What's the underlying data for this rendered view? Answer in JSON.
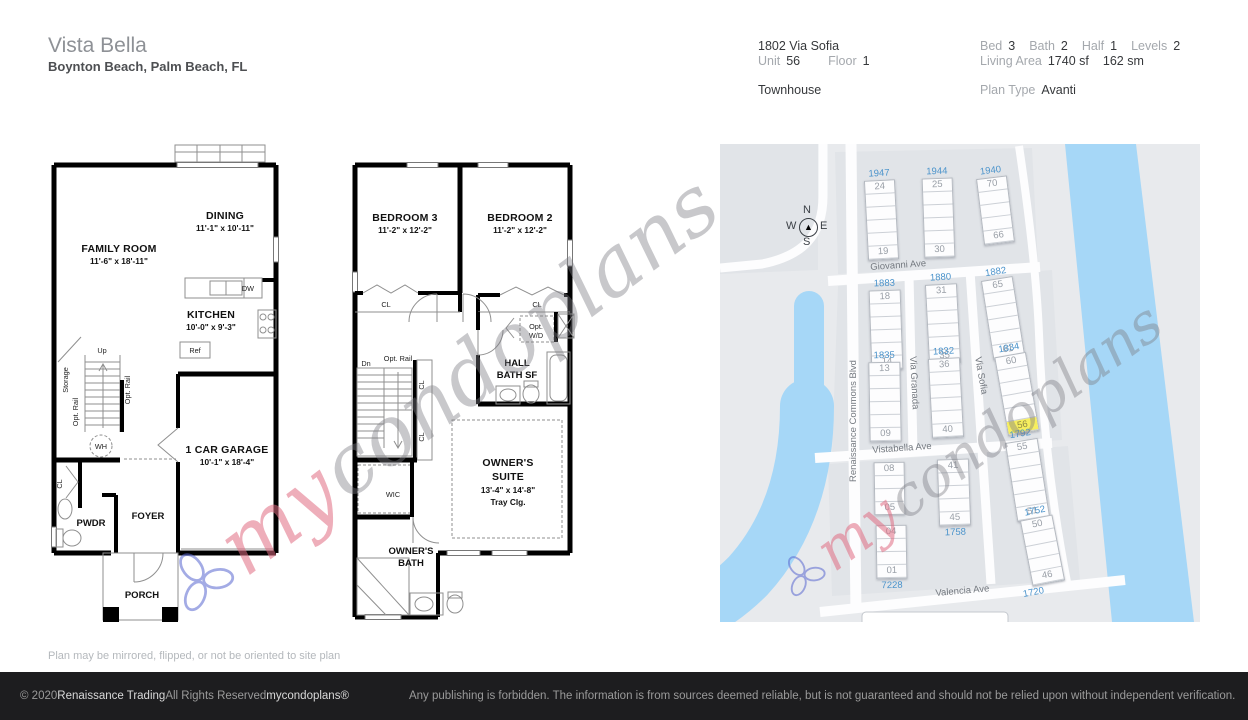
{
  "header": {
    "community": "Vista Bella",
    "location": "Boynton Beach, Palm Beach, FL",
    "address": "1802 Via Sofia",
    "unit_label": "Unit",
    "unit_value": "56",
    "floor_label": "Floor",
    "floor_value": "1",
    "property_type": "Townhouse",
    "bed_label": "Bed",
    "bed_value": "3",
    "bath_label": "Bath",
    "bath_value": "2",
    "half_label": "Half",
    "half_value": "1",
    "levels_label": "Levels",
    "levels_value": "2",
    "living_area_label": "Living Area",
    "living_area_sf": "1740 sf",
    "living_area_sm": "162 sm",
    "plan_type_label": "Plan Type",
    "plan_type_value": "Avanti"
  },
  "floor1": {
    "family_room": "FAMILY ROOM",
    "family_room_dims": "11'-6\" x 18'-11\"",
    "dining": "DINING",
    "dining_dims": "11'-1\" x 10'-11\"",
    "kitchen": "KITCHEN",
    "kitchen_dims": "10'-0\" x 9'-3\"",
    "garage": "1 CAR GARAGE",
    "garage_dims": "10'-1\" x 18'-4\"",
    "pwdr": "PWDR",
    "foyer": "FOYER",
    "porch": "PORCH",
    "storage": "Storage",
    "up": "Up",
    "wh": "WH",
    "ref": "Ref",
    "dw": "DW",
    "cl": "CL",
    "opt_rail": "Opt. Rail"
  },
  "floor2": {
    "bedroom3": "BEDROOM 3",
    "bedroom3_dims": "11'-2\" x 12'-2\"",
    "bedroom2": "BEDROOM 2",
    "bedroom2_dims": "11'-2\" x 12'-2\"",
    "owners_suite_1": "OWNER'S",
    "owners_suite_2": "SUITE",
    "owners_suite_dims": "13'-4\" x 14'-8\"",
    "tray": "Tray Clg.",
    "hall_bath_1": "HALL",
    "hall_bath_2": "BATH SF",
    "owners_bath_1": "OWNER'S",
    "owners_bath_2": "BATH",
    "wic": "WIC",
    "dn": "Dn",
    "opt_rail": "Opt. Rail",
    "opt_wd_1": "Opt.",
    "opt_wd_2": "W/D",
    "cl": "CL"
  },
  "watermark": {
    "part1": "my",
    "part2": "condoplans"
  },
  "site_map": {
    "colors": {
      "accent_blue": "#4a93cb",
      "highlight_yellow": "#f6ee5e",
      "water": "#a6d7f7"
    },
    "compass": {
      "n": "N",
      "e": "E",
      "s": "S",
      "w": "W",
      "arrow": "compass-arrow"
    },
    "streets": {
      "giovanni": "Giovanni Ave",
      "vistabella": "Vistabella Ave",
      "valencia": "Valencia Ave",
      "renaissance": "Renaissance Commons Blvd",
      "via_granada": "Via Granada",
      "via_sofia": "Via Sofia"
    },
    "highlighted_unit": "56",
    "buildings": [
      {
        "n": "1947",
        "x": 146,
        "y": 36,
        "w": 31,
        "rows": 6,
        "top": "24",
        "bottom": "19",
        "rot": -3,
        "numPos": "top"
      },
      {
        "n": "1944",
        "x": 203,
        "y": 34,
        "w": 31,
        "rows": 6,
        "top": "25",
        "bottom": "30",
        "rot": -2,
        "numPos": "top"
      },
      {
        "n": "1940",
        "x": 260,
        "y": 33,
        "w": 31,
        "rows": 5,
        "top": "70",
        "bottom": "66",
        "rot": -7,
        "numPos": "top"
      },
      {
        "n": "1883",
        "x": 150,
        "y": 146,
        "w": 32,
        "rows": 6,
        "top": "18",
        "bottom": "14",
        "rot": -2,
        "numPos": "top"
      },
      {
        "n": "1880",
        "x": 207,
        "y": 140,
        "w": 32,
        "rows": 6,
        "top": "31",
        "bottom": "35",
        "rot": -3,
        "numPos": "top"
      },
      {
        "n": "1882",
        "x": 267,
        "y": 134,
        "w": 32,
        "rows": 6,
        "top": "65",
        "bottom": "61",
        "rot": -9,
        "numPos": "top"
      },
      {
        "n": "1835",
        "x": 149,
        "y": 218,
        "w": 32,
        "rows": 6,
        "top": "13",
        "bottom": "09",
        "rot": -1,
        "numPos": "top"
      },
      {
        "n": "1832",
        "x": 210,
        "y": 214,
        "w": 32,
        "rows": 6,
        "top": "36",
        "bottom": "40",
        "rot": -3,
        "numPos": "top"
      },
      {
        "n": "1834",
        "x": 281,
        "y": 210,
        "w": 32,
        "rows": 6,
        "top": "60",
        "bottom": "56",
        "rot": -10,
        "numPos": "top",
        "hl": "bottom"
      },
      {
        "n": null,
        "x": 154,
        "y": 318,
        "w": 31,
        "rows": 4,
        "top": "08",
        "bottom": "05",
        "rot": -1,
        "numPos": null
      },
      {
        "n": "7228",
        "x": 156,
        "y": 381,
        "w": 31,
        "rows": 4,
        "top": "04",
        "bottom": "01",
        "rot": -1,
        "numPos": "bottom"
      },
      {
        "n": "1758",
        "x": 218,
        "y": 315,
        "w": 32,
        "rows": 5,
        "top": "41",
        "bottom": "45",
        "rot": -2,
        "numPos": "bottom"
      },
      {
        "n": "1792",
        "x": 291,
        "y": 296,
        "w": 33,
        "rows": 6,
        "top": "55",
        "bottom": "51",
        "rot": -9,
        "numPos": "top"
      },
      {
        "n": "1752",
        "x": 306,
        "y": 373,
        "w": 33,
        "rows": 5,
        "top": "50",
        "bottom": "46",
        "rot": -11,
        "numPos": "top"
      }
    ],
    "extra_labels": [
      {
        "text": "1720",
        "x": 303,
        "y": 443,
        "rot": -11
      }
    ]
  },
  "plan_note": "Plan may be mirrored, flipped, or not be oriented to site plan",
  "footer": {
    "copyright": "© 2020",
    "company": "Renaissance Trading",
    "rights": "All Rights Reserved",
    "brand": "mycondoplans®",
    "disclaimer": "Any publishing is forbidden.  The information is from sources deemed reliable, but is not guaranteed and should not be relied upon without independent verification."
  }
}
